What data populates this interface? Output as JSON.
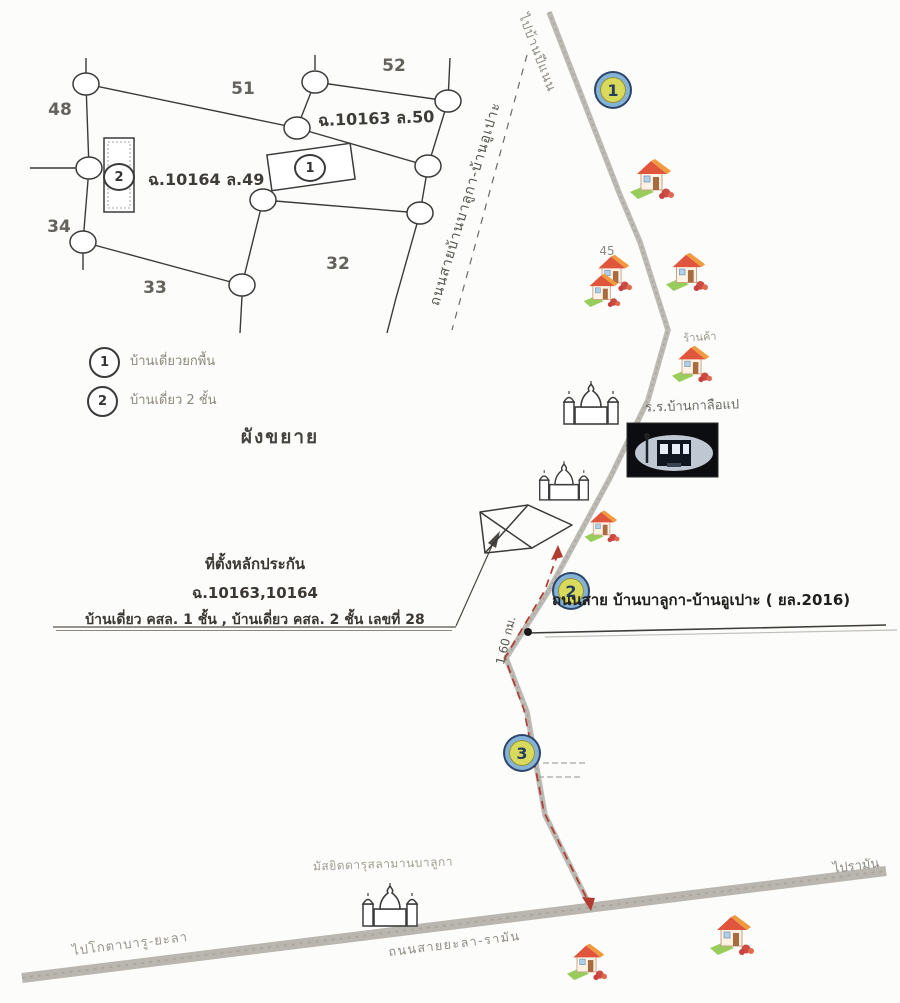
{
  "inset": {
    "parcels": {
      "p48": "48",
      "p51": "51",
      "p52": "52",
      "p34": "34",
      "p33": "33",
      "p32": "32"
    },
    "deeds": {
      "deed_50": "ฉ.10163 ล.50",
      "deed_49": "ฉ.10164 ล.49"
    },
    "markers": {
      "m1": "1",
      "m2": "2"
    }
  },
  "legend": {
    "item1": {
      "marker": "1",
      "label": "บ้านเดี่ยวยกพื้น"
    },
    "item2": {
      "marker": "2",
      "label": "บ้านเดี่ยว 2 ชั้น"
    },
    "title": "ผังขยาย"
  },
  "route": {
    "badge1": "1",
    "badge2": "2",
    "badge3": "3",
    "to_pinaen": "ไปบ้านปีแนน",
    "road_diagonal": "ถนนสายบ้านบาลูกา-บ้านอูเปาะ",
    "house_no_45": "45",
    "shop": "ร้านค้า",
    "school": "ร.ร.บ้านกาลือแป",
    "road_2016": "ถนนสาย บ้านบาลูกา-บ้านอูเปาะ ( ยล.2016)",
    "distance": "1.60 กม.",
    "mosque": "มัสยิดดารุสลามานบาลูกา",
    "to_kotabaru": "ไปโกตาบารู-ยะลา",
    "road_yala_raman": "ถนนสายยะลา-รามัน",
    "to_raman": "ไปรามัน"
  },
  "note": {
    "line1": "ที่ตั้งหลักประกัน",
    "line2": "ฉ.10163,10164",
    "line3": "บ้านเดี่ยว คสล. 1 ชั้น , บ้านเดี่ยว คสล. 2 ชั้น เลขที่ 28"
  },
  "colors": {
    "route_dash": "#b23b32",
    "road_gray": "#b7b4ae",
    "badge_fill": "#d9da5c",
    "badge_ring": "#84b2d6",
    "badge_border": "#2b4468",
    "ink": "#3a3a3a"
  }
}
